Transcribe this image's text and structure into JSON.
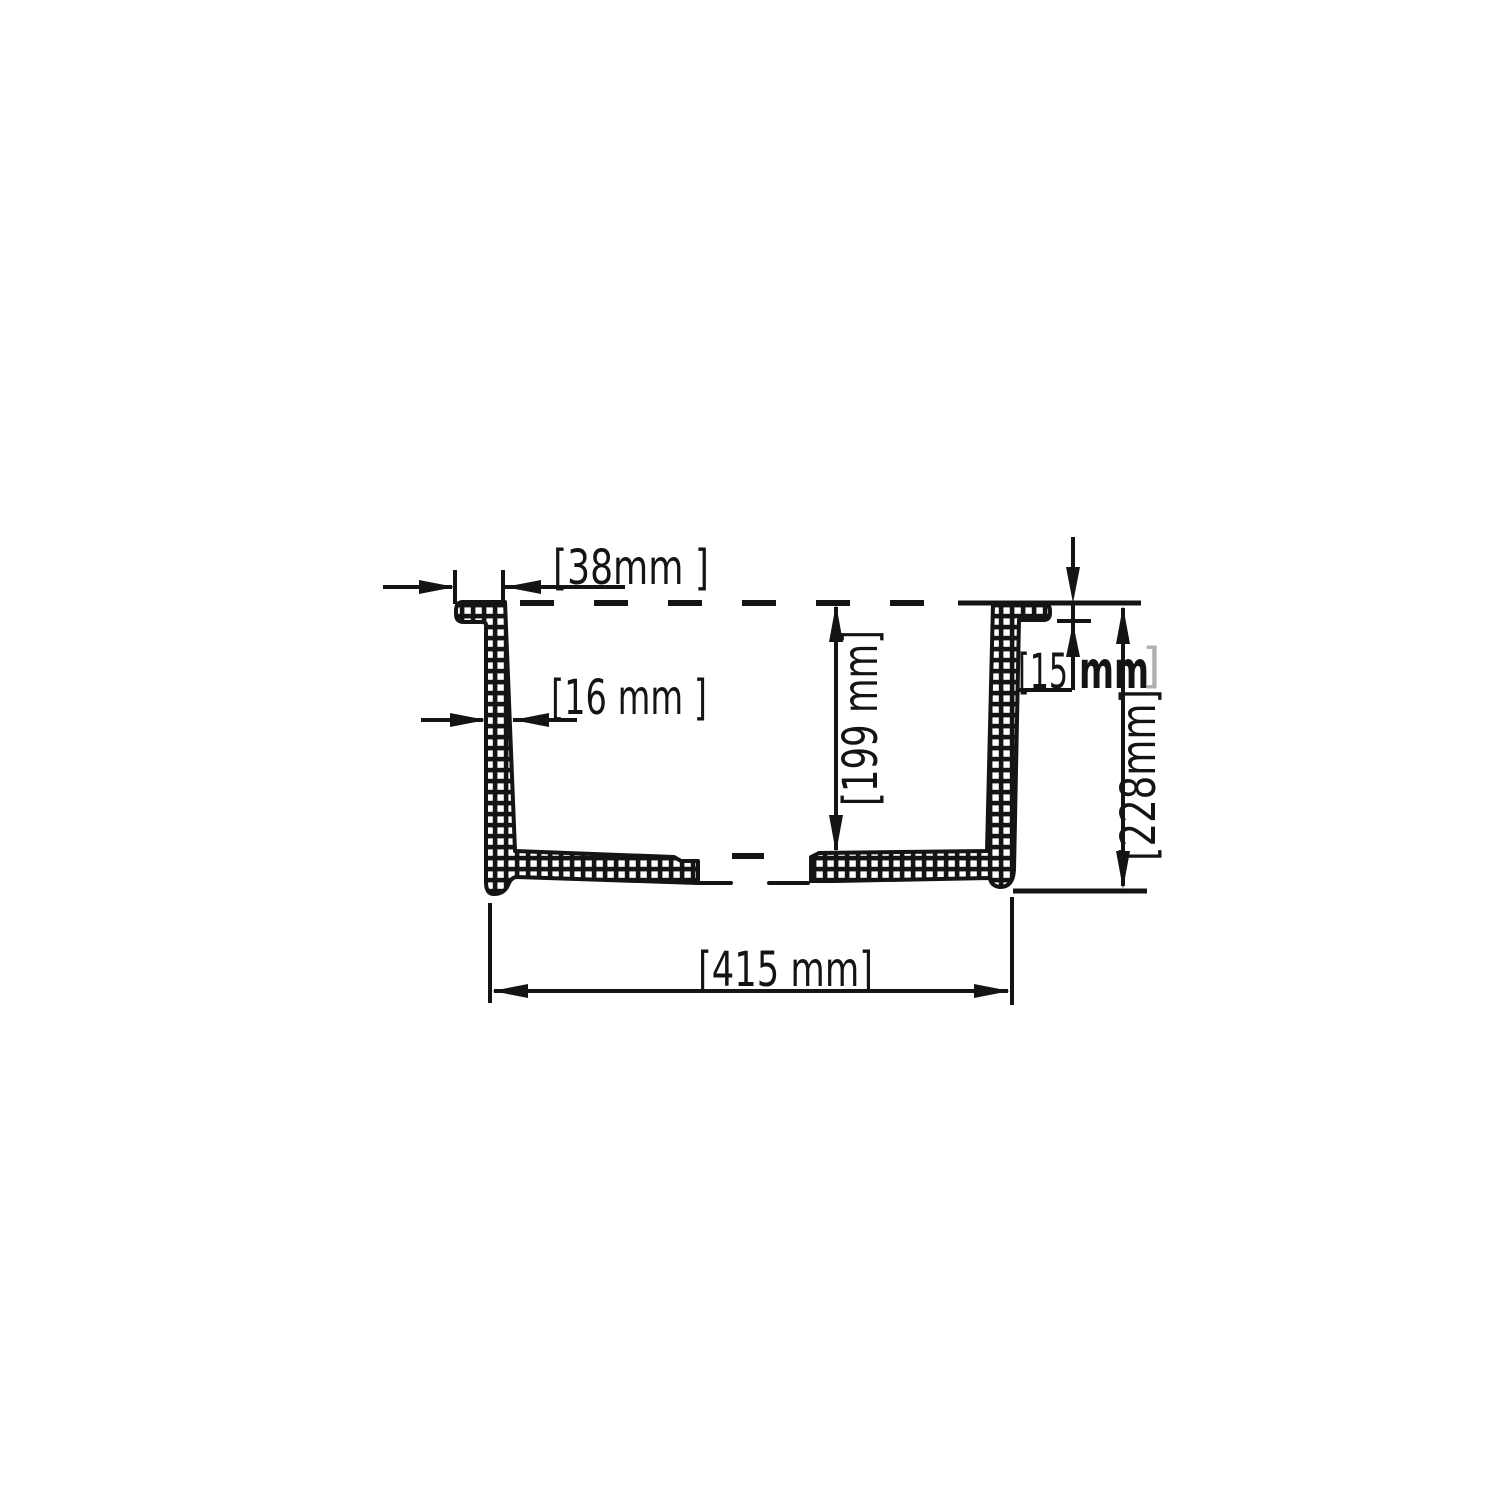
{
  "drawing": {
    "kind": "sink-cross-section",
    "units": "mm",
    "colors": {
      "ink": "#141414",
      "background": "#ffffff",
      "muted_bracket": "#b0b0b0"
    },
    "dimensions": {
      "flange_width": {
        "value": 38,
        "label": "[38mm ]"
      },
      "wall_thickness": {
        "value": 16,
        "label": "[16 mm ]"
      },
      "bowl_depth": {
        "value": 199,
        "label": "[199 mm]"
      },
      "rim_thickness": {
        "value": 15,
        "label_open": "[15",
        "label_unit": "mm",
        "label_close": "]"
      },
      "overall_height": {
        "value": 228,
        "label": "[228mm]"
      },
      "overall_width": {
        "value": 415,
        "label": "[415 mm]"
      }
    }
  }
}
